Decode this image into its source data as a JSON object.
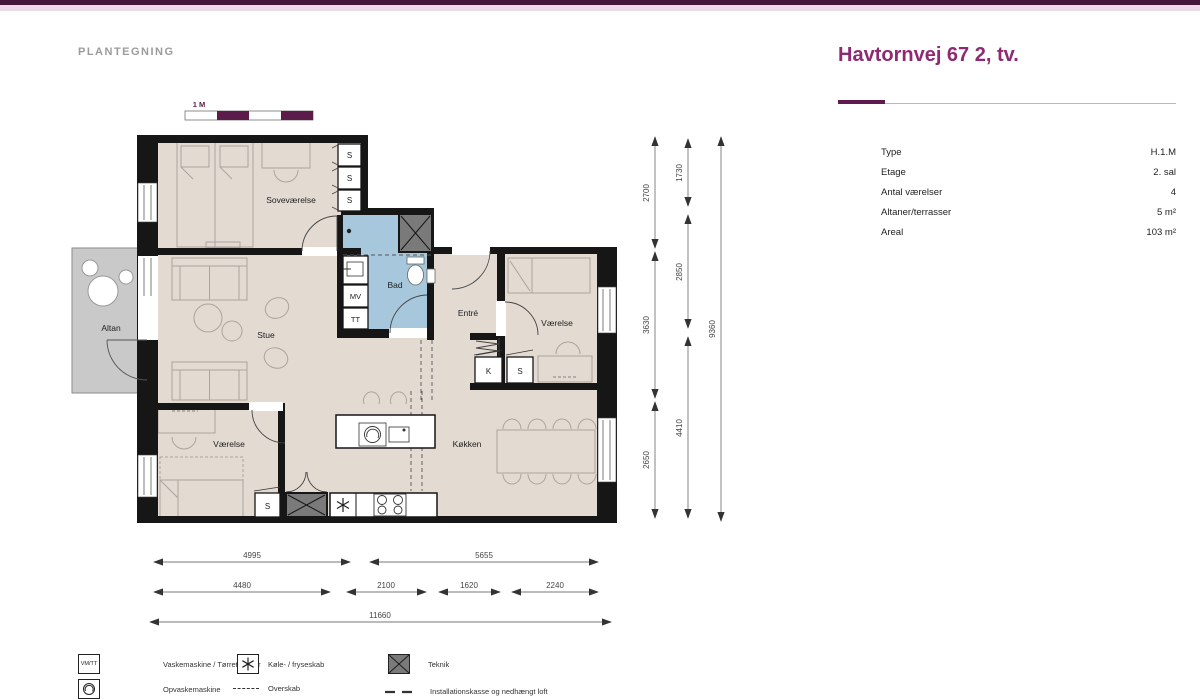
{
  "header": {
    "section_label": "PLANTEGNING",
    "title": "Havtornvej 67 2, tv."
  },
  "scale_bar": {
    "label": "1 M"
  },
  "info_panel": {
    "rows": [
      {
        "label": "Type",
        "value": "H.1.M"
      },
      {
        "label": "Etage",
        "value": "2. sal"
      },
      {
        "label": "Antal værelser",
        "value": "4"
      },
      {
        "label": "Altaner/terrasser",
        "value": "5 m²"
      },
      {
        "label": "Areal",
        "value": "103 m²"
      }
    ]
  },
  "plan": {
    "room_labels": {
      "soevaerelse": "Soveværelse",
      "stue": "Stue",
      "altan": "Altan",
      "bad": "Bad",
      "entre": "Entré",
      "vaerelse_top": "Værelse",
      "vaerelse_bottom": "Værelse",
      "koekken": "Køkken"
    },
    "unit_labels": {
      "s": "S",
      "k": "K",
      "mv": "MV",
      "tt": "TT"
    },
    "dimensions": {
      "vertical": [
        {
          "value": "2700"
        },
        {
          "value": "3630"
        },
        {
          "value": "2650"
        },
        {
          "value": "1730"
        },
        {
          "value": "2850"
        },
        {
          "value": "4410"
        },
        {
          "value": "9360"
        }
      ],
      "horizontal": [
        {
          "value": "4995"
        },
        {
          "value": "5655"
        },
        {
          "value": "4480"
        },
        {
          "value": "2100"
        },
        {
          "value": "1620"
        },
        {
          "value": "2240"
        },
        {
          "value": "11660"
        }
      ]
    }
  },
  "legend": {
    "items": [
      {
        "icon": "washer-dryer-box-icon",
        "symbol_text": "VM/TT",
        "label": "Vaskemaskine / Tørretumbler"
      },
      {
        "icon": "freezer-asterisk-icon",
        "label": "Køle- / fryseskab"
      },
      {
        "icon": "technic-box-icon",
        "label": "Teknik"
      },
      {
        "icon": "dishwasher-icon",
        "label": "Opvaskemaskine"
      },
      {
        "icon": "dashed-line-icon",
        "label": "Overskab"
      },
      {
        "icon": "long-dash-icon",
        "label": "Installationskasse og nedhængt loft"
      }
    ]
  },
  "colors": {
    "brand_bar_dark": "#451739",
    "brand_bar_pink": "#EDD9E8",
    "title_purple": "#8E2A72",
    "scale_purple": "#5B1B4B",
    "wall": "#161616",
    "room_fill": "#E3DAD2",
    "bath_fill": "#A6C7DC",
    "balcony_fill": "#C9C9C9",
    "technic_fill": "#7A7A7A"
  }
}
